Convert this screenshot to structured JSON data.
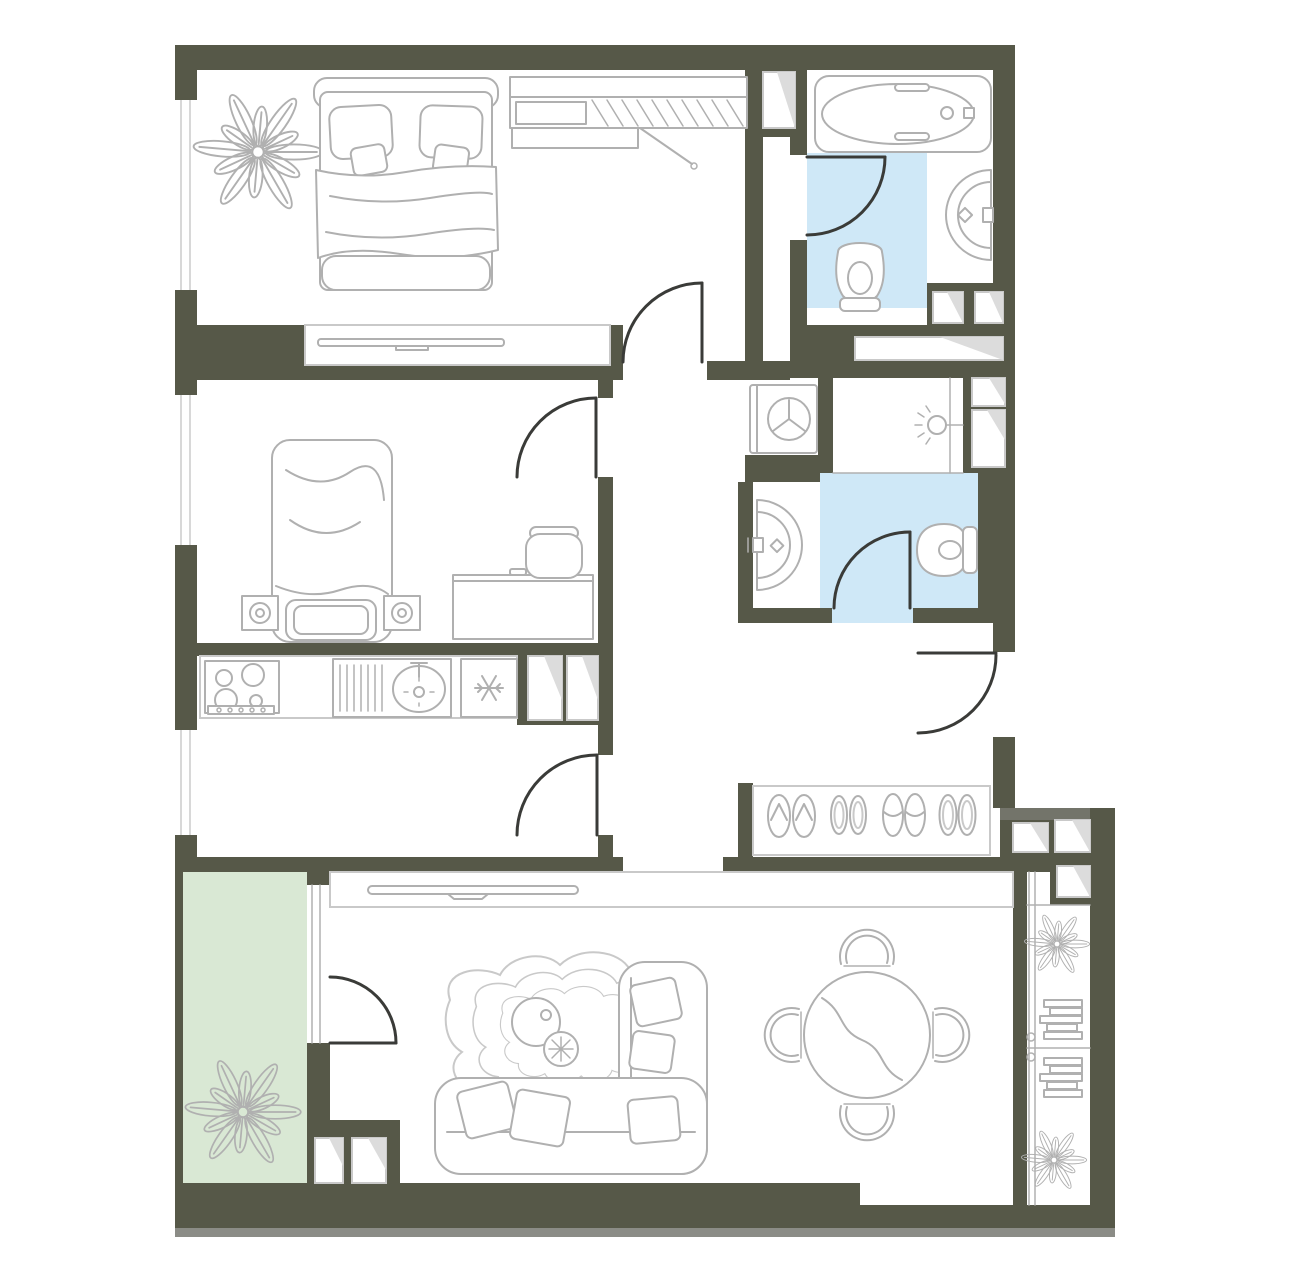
{
  "meta": {
    "kind": "apartment-floor-plan",
    "visible_text": ""
  },
  "colors": {
    "paper": "#ffffff",
    "wall": "#565848",
    "wall_light": "#73746a",
    "shadow": "#8b8c86",
    "line": "#b0b0b0",
    "outline": "#c9c9c9",
    "door": "#3a3b38",
    "wet_floor": "#cfe8f7",
    "balcony_floor": "#d9e8d4",
    "fold": "#dcdcdc"
  },
  "rooms": [
    {
      "name": "bedroom-primary",
      "floor": "white"
    },
    {
      "name": "bathroom-main",
      "floor": "wet_floor"
    },
    {
      "name": "bedroom-secondary",
      "floor": "white"
    },
    {
      "name": "shower-room",
      "floor": "white"
    },
    {
      "name": "bathroom-guest",
      "floor": "wet_floor"
    },
    {
      "name": "kitchen",
      "floor": "white"
    },
    {
      "name": "corridor",
      "floor": "white"
    },
    {
      "name": "entry-hall",
      "floor": "white"
    },
    {
      "name": "living-room",
      "floor": "white"
    },
    {
      "name": "balcony-left",
      "floor": "balcony_floor"
    },
    {
      "name": "balcony-right",
      "floor": "white"
    }
  ],
  "fixtures": [
    "double-bed",
    "wardrobe",
    "plant",
    "tv-shelf",
    "bathtub",
    "toilet",
    "pedestal-sink",
    "washing-machine",
    "shower-head",
    "single-bed",
    "speaker",
    "desk",
    "desk-chair",
    "stove",
    "dish-rack",
    "kitchen-sink",
    "fridge",
    "shoe-rack",
    "flip-flops",
    "shoes",
    "slippers",
    "tv-console",
    "rug",
    "coffee-table",
    "side-table",
    "corner-sofa",
    "dining-table",
    "dining-chair",
    "shelf-stack",
    "vent-shaft",
    "door-swing",
    "window",
    "entrance-door"
  ]
}
